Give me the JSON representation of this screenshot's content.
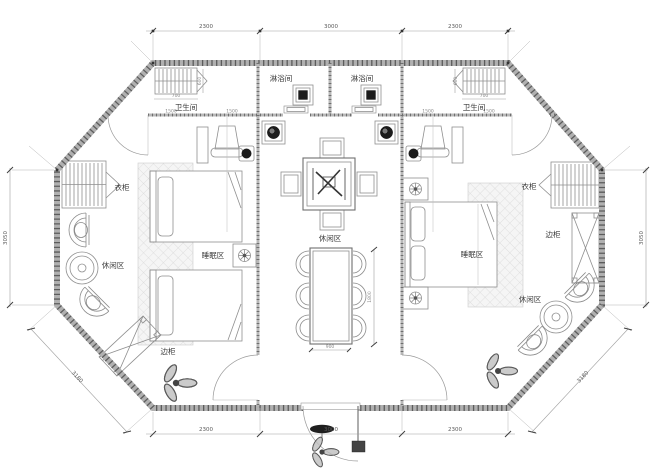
{
  "title": "octagonal-twin-suite-floor-plan",
  "colors": {
    "background": "#ffffff",
    "wall_dark": "#5c5c5c",
    "wall_light": "#b0b0b0",
    "furniture_line": "#8f8f8f",
    "dark_fixture": "#1c1c1c",
    "label_text": "#3a3a3a",
    "dimension_text": "#595959"
  },
  "rooms": {
    "shower_left": "淋浴间",
    "shower_right": "淋浴间",
    "toilet_left": "卫生间",
    "toilet_right": "卫生间",
    "wardrobe_left": "衣柜",
    "wardrobe_right": "衣柜",
    "sleep_left": "睡眠区",
    "sleep_right": "睡眠区",
    "leisure_left": "休闲区",
    "leisure_center": "休闲区",
    "leisure_right": "休闲区",
    "cabinet_left": "边柜",
    "cabinet_right": "边柜"
  },
  "dimensions": {
    "top": [
      "2300",
      "3000",
      "2300"
    ],
    "bottom": [
      "2300",
      "3000",
      "2300"
    ],
    "side_left": "3050",
    "side_right": "3050",
    "diag_left": "3180",
    "diag_right": "3180",
    "inner": {
      "fixture": "700",
      "depth": "600",
      "seg": "1500",
      "table_w": "900",
      "table_l": "1800"
    }
  }
}
